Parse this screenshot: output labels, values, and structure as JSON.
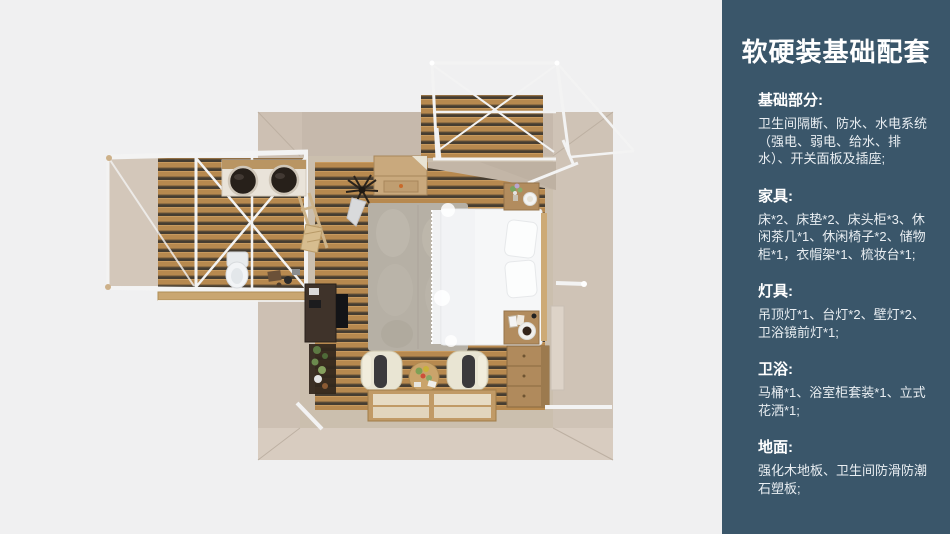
{
  "page": {
    "background": "#f0f0f1"
  },
  "sidebar": {
    "background": "#3a566a",
    "title": "软硬装基础配套",
    "sections": [
      {
        "heading": "基础部分:",
        "body": "卫生间隔断、防水、水电系统（强电、弱电、给水、排水）、开关面板及插座;"
      },
      {
        "heading": "家具:",
        "body": "床*2、床垫*2、床头柜*3、休闲茶几*1、休闲椅子*2、储物柜*1，衣帽架*1、梳妆台*1;"
      },
      {
        "heading": "灯具:",
        "body": "吊顶灯*1、台灯*2、壁灯*2、卫浴镜前灯*1;"
      },
      {
        "heading": "卫浴:",
        "body": "马桶*1、浴室柜套装*1、立式花洒*1;"
      },
      {
        "heading": "地面:",
        "body": "强化木地板、卫生间防滑防潮石塑板;"
      }
    ]
  },
  "floorplan": {
    "view": "top-down 3d room render",
    "colors": {
      "background": "#f0f0f1",
      "wall": "#d0c4b7",
      "wood_floor": "#b7894f",
      "plank_gap": "#463d31",
      "inner_floor": "#cbbfae",
      "frame_white": "#f3f3f3",
      "bed_white": "#f6f7f8",
      "rug_gray": "#b6b0a5",
      "tatami_panel": "#e7dbc4",
      "armchair_cream": "#e9e5d3",
      "dark_furniture": "#3a2e24"
    }
  }
}
